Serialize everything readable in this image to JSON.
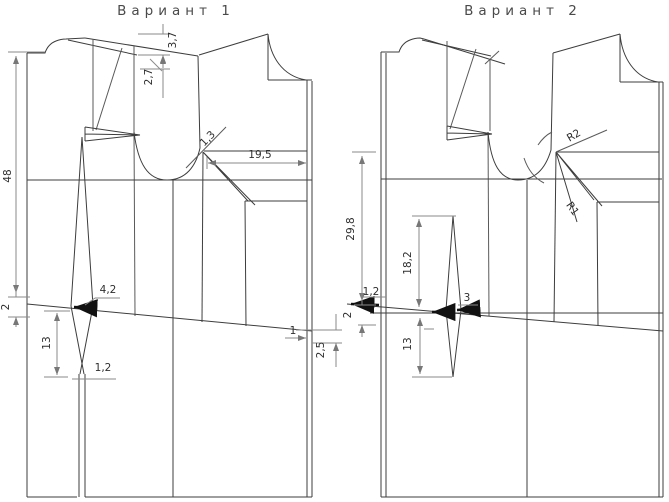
{
  "figure": {
    "description": "Sewing pattern drafting diagram, two bodice dart-transfer variants",
    "colors": {
      "pattern_line": "#3d3d3d",
      "dimension_line": "#8a8a8a",
      "emphasis_mark": "#111111",
      "background": "#ffffff",
      "text": "#2e2e2e"
    }
  },
  "v1": {
    "title": "Вариант 1",
    "d48": "48",
    "d2": "2",
    "d3_7": "3,7",
    "d2_7": "2,7",
    "d1_3": "1,3",
    "d19_5": "19,5",
    "d4_2": "4,2",
    "d13": "13",
    "d1_2": "1,2",
    "d1": "1",
    "d2_5": "2,5"
  },
  "v2": {
    "title": "Вариант 2",
    "d29_8": "29,8",
    "d2": "2",
    "d1_2": "1,2",
    "d18_2": "18,2",
    "d3": "3",
    "d13": "13",
    "r1": "R1",
    "r2": "R2"
  }
}
